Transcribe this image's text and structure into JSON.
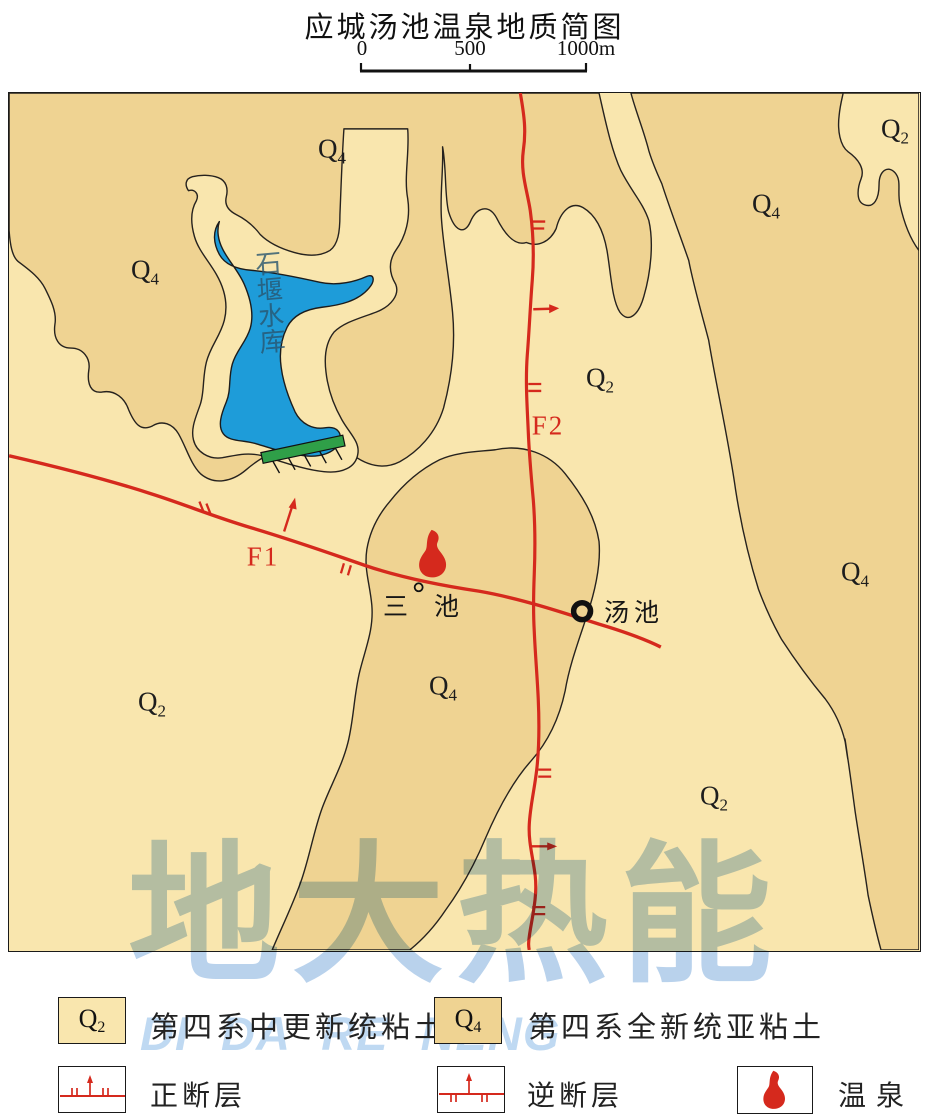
{
  "title": "应城汤池温泉地质简图",
  "scale_bar": {
    "ticks": [
      "0",
      "500",
      "1000m"
    ]
  },
  "map": {
    "unit_labels": [
      {
        "base": "Q",
        "sub": "4"
      },
      {
        "base": "Q",
        "sub": "4"
      },
      {
        "base": "Q",
        "sub": "2"
      },
      {
        "base": "Q",
        "sub": "4"
      },
      {
        "base": "Q",
        "sub": "2"
      },
      {
        "base": "Q",
        "sub": "4"
      },
      {
        "base": "Q",
        "sub": "4"
      },
      {
        "base": "Q",
        "sub": "2"
      },
      {
        "base": "Q",
        "sub": "2"
      }
    ],
    "fault_labels": [
      {
        "text": "F1"
      },
      {
        "text": "F2"
      }
    ],
    "place_labels": [
      {
        "text": "三池"
      },
      {
        "text": "汤池"
      }
    ],
    "lake_label": {
      "text": "石堰水库"
    }
  },
  "watermark": {
    "line1": "地大热能",
    "line2": "DI DA RE NENG"
  },
  "legend": {
    "units": [
      {
        "base": "Q",
        "sub": "2",
        "label": "第四系中更新统粘土"
      },
      {
        "base": "Q",
        "sub": "4",
        "label": "第四系全新统亚粘土"
      }
    ],
    "faults": [
      {
        "label": "正断层"
      },
      {
        "label": "逆断层"
      }
    ],
    "spring": {
      "label": "温泉"
    }
  },
  "colors": {
    "q2_fill": "#F9E6AE",
    "q4_fill": "#EFD392",
    "lake_blue": "#1E9CD9",
    "dam_green": "#2F9F48",
    "fault_red": "#D5291D",
    "watermark_cjk": "#b9d2ec",
    "watermark_latin": "#bfd9f2"
  }
}
